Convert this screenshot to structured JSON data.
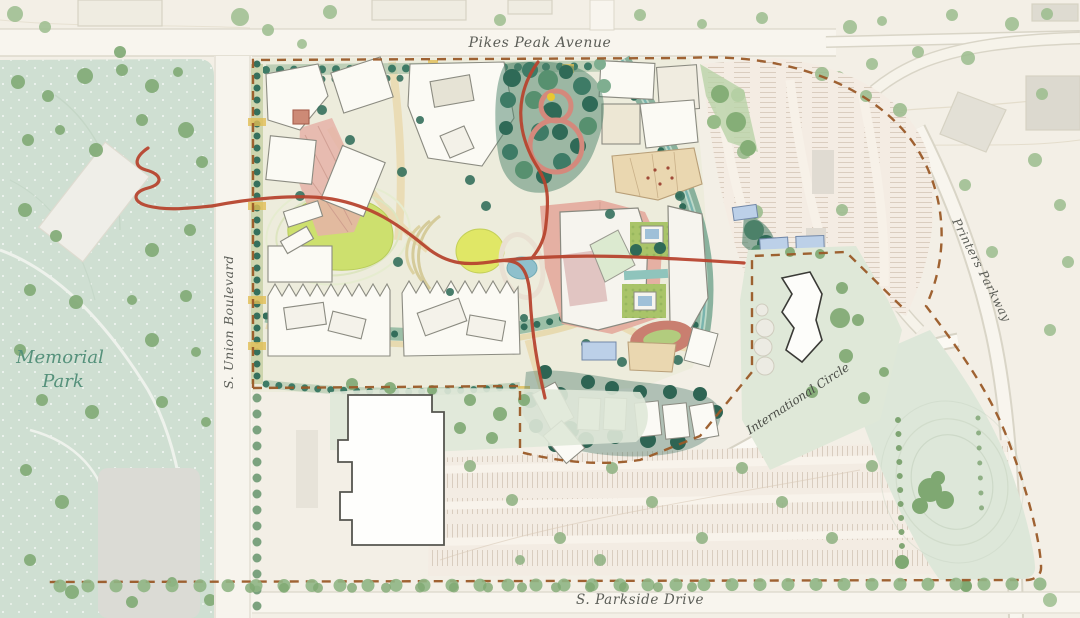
{
  "page": {
    "type": "campus-master-plan-site-rendering"
  },
  "map": {
    "park_name_line1": "Memorial",
    "park_name_line2": "Park",
    "roads": {
      "north": "Pikes Peak Avenue",
      "west": "S. Union Boulevard",
      "south": "S. Parkside Drive",
      "east": "Printers Parkway",
      "internal": "International Circle"
    },
    "colors": {
      "background_cream": "#f3efe6",
      "park_green": "#cfdfd2",
      "context_tree_green": "#8fb584",
      "street_tree_teal": "#35705d",
      "lawn_yellow_green": "#cde06e",
      "trail_red": "#b7452f",
      "boundary_dash_brown": "#9a5a28",
      "plaza_pink": "#e3aa9c",
      "building_white": "#fbfaf4",
      "water_blue": "#8fc0cc",
      "parking_tan": "#f3ece3",
      "road_label_gray": "#5b5d57",
      "park_label_green": "#55917b"
    }
  }
}
